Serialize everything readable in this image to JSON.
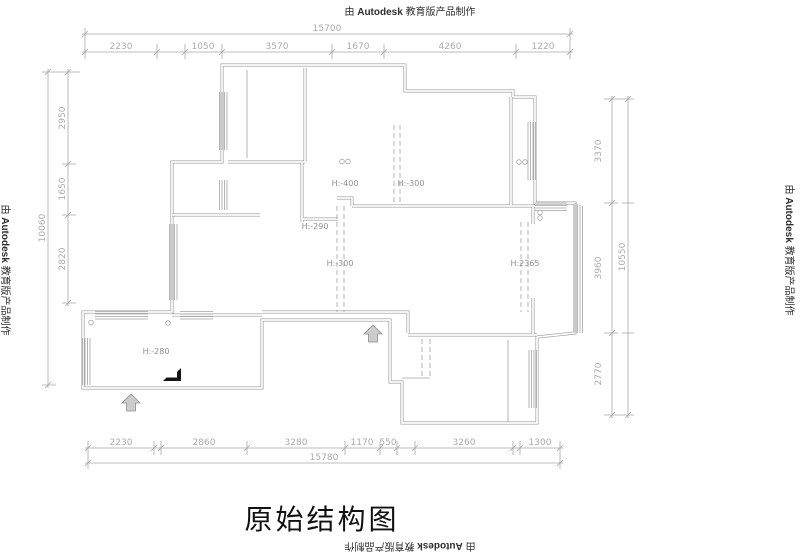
{
  "watermark": {
    "prefix": "由",
    "brand": "Autodesk",
    "suffix": "教育版产品制作"
  },
  "title": "原始结构图",
  "dimensions": {
    "top": {
      "overall": "15700",
      "segments": [
        "2230",
        "1050",
        "3570",
        "1670",
        "4260",
        "1220"
      ]
    },
    "bottom": {
      "overall": "15780",
      "segments": [
        "2230",
        "2860",
        "3280",
        "1170",
        "550",
        "3260",
        "1300"
      ]
    },
    "left": {
      "overall": "10060",
      "segments": [
        "2950",
        "1650",
        "2820"
      ]
    },
    "right": {
      "overall": "10550",
      "segments": [
        "3370",
        "3960",
        "2770"
      ]
    }
  },
  "plan_labels": {
    "upper_mid_left": "H:-400",
    "upper_mid_right": "H:-300",
    "mid_left": "H:-290",
    "center": "H:-300",
    "right": "H:2365",
    "lower_left": "H:-280"
  },
  "colors": {
    "line": "#9a9a9a",
    "dim_text": "#ababab",
    "title": "#111111",
    "watermark": "#2e2e2e"
  }
}
